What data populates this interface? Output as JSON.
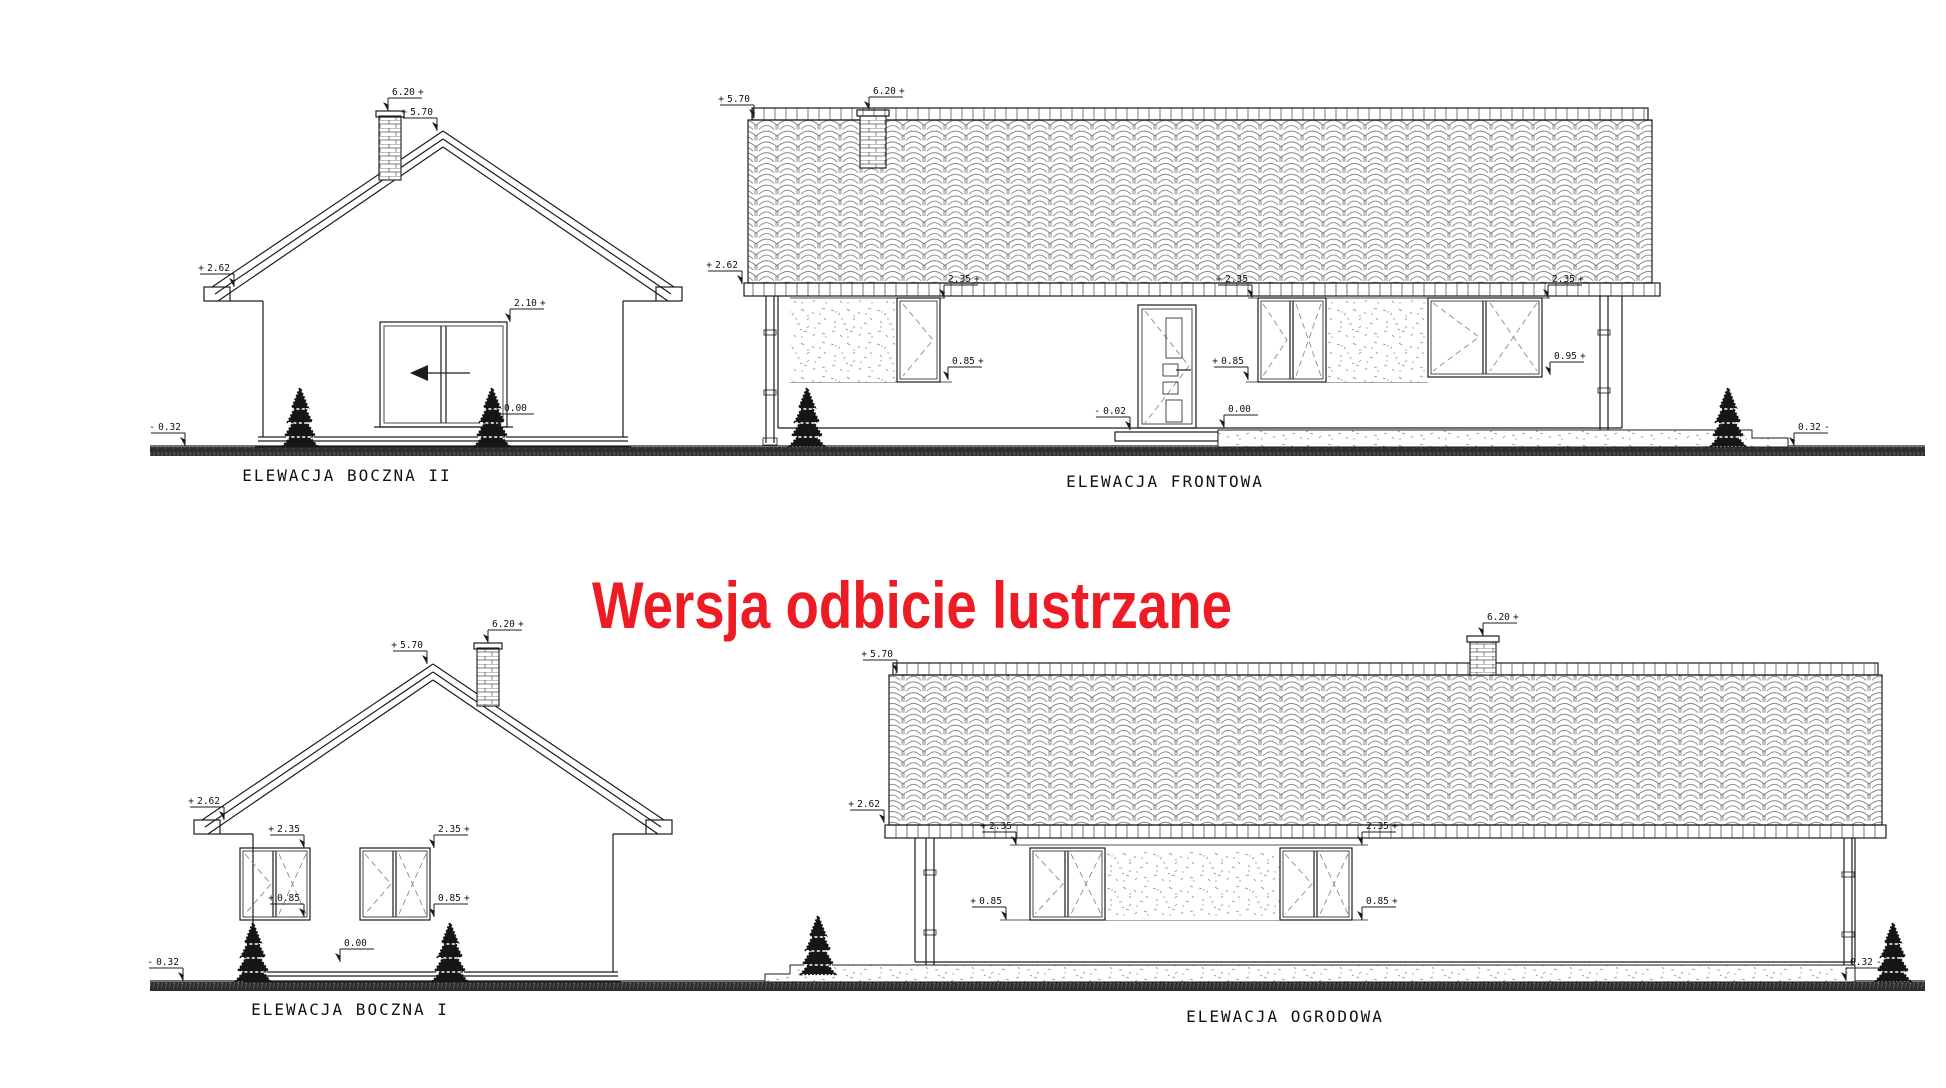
{
  "page": {
    "background": "#ffffff",
    "line_color": "#1c1c1c"
  },
  "title": {
    "text": "Wersja odbicie lustrzane",
    "color": "#ed1b24"
  },
  "elevations": {
    "boczna2": {
      "caption": "ELEWACJA BOCZNA II",
      "levels": [
        {
          "sign": "+",
          "value": "6.20",
          "x": 388,
          "y": 111,
          "side": "right"
        },
        {
          "sign": "+",
          "value": "5.70",
          "x": 437,
          "y": 131,
          "side": "left"
        },
        {
          "sign": "+",
          "value": "2.62",
          "x": 234,
          "y": 287,
          "side": "left"
        },
        {
          "sign": "+",
          "value": "2.10",
          "x": 510,
          "y": 322,
          "side": "right"
        },
        {
          "sign": "",
          "value": "0.00",
          "x": 500,
          "y": 427,
          "side": "right"
        },
        {
          "sign": "-",
          "value": "0.32",
          "x": 185,
          "y": 446,
          "side": "left"
        }
      ]
    },
    "frontowa": {
      "caption": "ELEWACJA FRONTOWA",
      "levels": [
        {
          "sign": "+",
          "value": "6.20",
          "x": 869,
          "y": 110,
          "side": "right"
        },
        {
          "sign": "+",
          "value": "5.70",
          "x": 754,
          "y": 118,
          "side": "left"
        },
        {
          "sign": "+",
          "value": "2.62",
          "x": 742,
          "y": 284,
          "side": "left"
        },
        {
          "sign": "+",
          "value": "2.35",
          "x": 944,
          "y": 298,
          "side": "right"
        },
        {
          "sign": "+",
          "value": "0.85",
          "x": 948,
          "y": 380,
          "side": "right"
        },
        {
          "sign": "+",
          "value": "2.35",
          "x": 1252,
          "y": 298,
          "side": "left"
        },
        {
          "sign": "+",
          "value": "0.85",
          "x": 1248,
          "y": 380,
          "side": "left"
        },
        {
          "sign": "+",
          "value": "2.35",
          "x": 1548,
          "y": 298,
          "side": "right"
        },
        {
          "sign": "+",
          "value": "0.95",
          "x": 1550,
          "y": 375,
          "side": "right"
        },
        {
          "sign": "-",
          "value": "0.02",
          "x": 1130,
          "y": 430,
          "side": "left"
        },
        {
          "sign": "",
          "value": "0.00",
          "x": 1224,
          "y": 428,
          "side": "right"
        },
        {
          "sign": "-",
          "value": "0.32",
          "x": 1794,
          "y": 446,
          "side": "right"
        }
      ]
    },
    "boczna1": {
      "caption": "ELEWACJA BOCZNA I",
      "levels": [
        {
          "sign": "+",
          "value": "6.20",
          "x": 488,
          "y": 643,
          "side": "right"
        },
        {
          "sign": "+",
          "value": "5.70",
          "x": 427,
          "y": 664,
          "side": "left"
        },
        {
          "sign": "+",
          "value": "2.62",
          "x": 224,
          "y": 820,
          "side": "left"
        },
        {
          "sign": "+",
          "value": "2.35",
          "x": 304,
          "y": 848,
          "side": "left"
        },
        {
          "sign": "+",
          "value": "0.85",
          "x": 304,
          "y": 917,
          "side": "left"
        },
        {
          "sign": "+",
          "value": "2.35",
          "x": 434,
          "y": 848,
          "side": "right"
        },
        {
          "sign": "+",
          "value": "0.85",
          "x": 434,
          "y": 917,
          "side": "right"
        },
        {
          "sign": "",
          "value": "0.00",
          "x": 340,
          "y": 962,
          "side": "right"
        },
        {
          "sign": "-",
          "value": "0.32",
          "x": 183,
          "y": 981,
          "side": "left"
        }
      ]
    },
    "ogrodowa": {
      "caption": "ELEWACJA OGRODOWA",
      "levels": [
        {
          "sign": "+",
          "value": "6.20",
          "x": 1483,
          "y": 636,
          "side": "right"
        },
        {
          "sign": "+",
          "value": "5.70",
          "x": 897,
          "y": 673,
          "side": "left"
        },
        {
          "sign": "+",
          "value": "2.62",
          "x": 884,
          "y": 823,
          "side": "left"
        },
        {
          "sign": "+",
          "value": "2.35",
          "x": 1016,
          "y": 845,
          "side": "left"
        },
        {
          "sign": "+",
          "value": "0.85",
          "x": 1006,
          "y": 920,
          "side": "left"
        },
        {
          "sign": "+",
          "value": "2.35",
          "x": 1362,
          "y": 845,
          "side": "right"
        },
        {
          "sign": "+",
          "value": "0.85",
          "x": 1362,
          "y": 920,
          "side": "right"
        },
        {
          "sign": "-",
          "value": "0.32",
          "x": 1846,
          "y": 981,
          "side": "right"
        }
      ]
    }
  }
}
